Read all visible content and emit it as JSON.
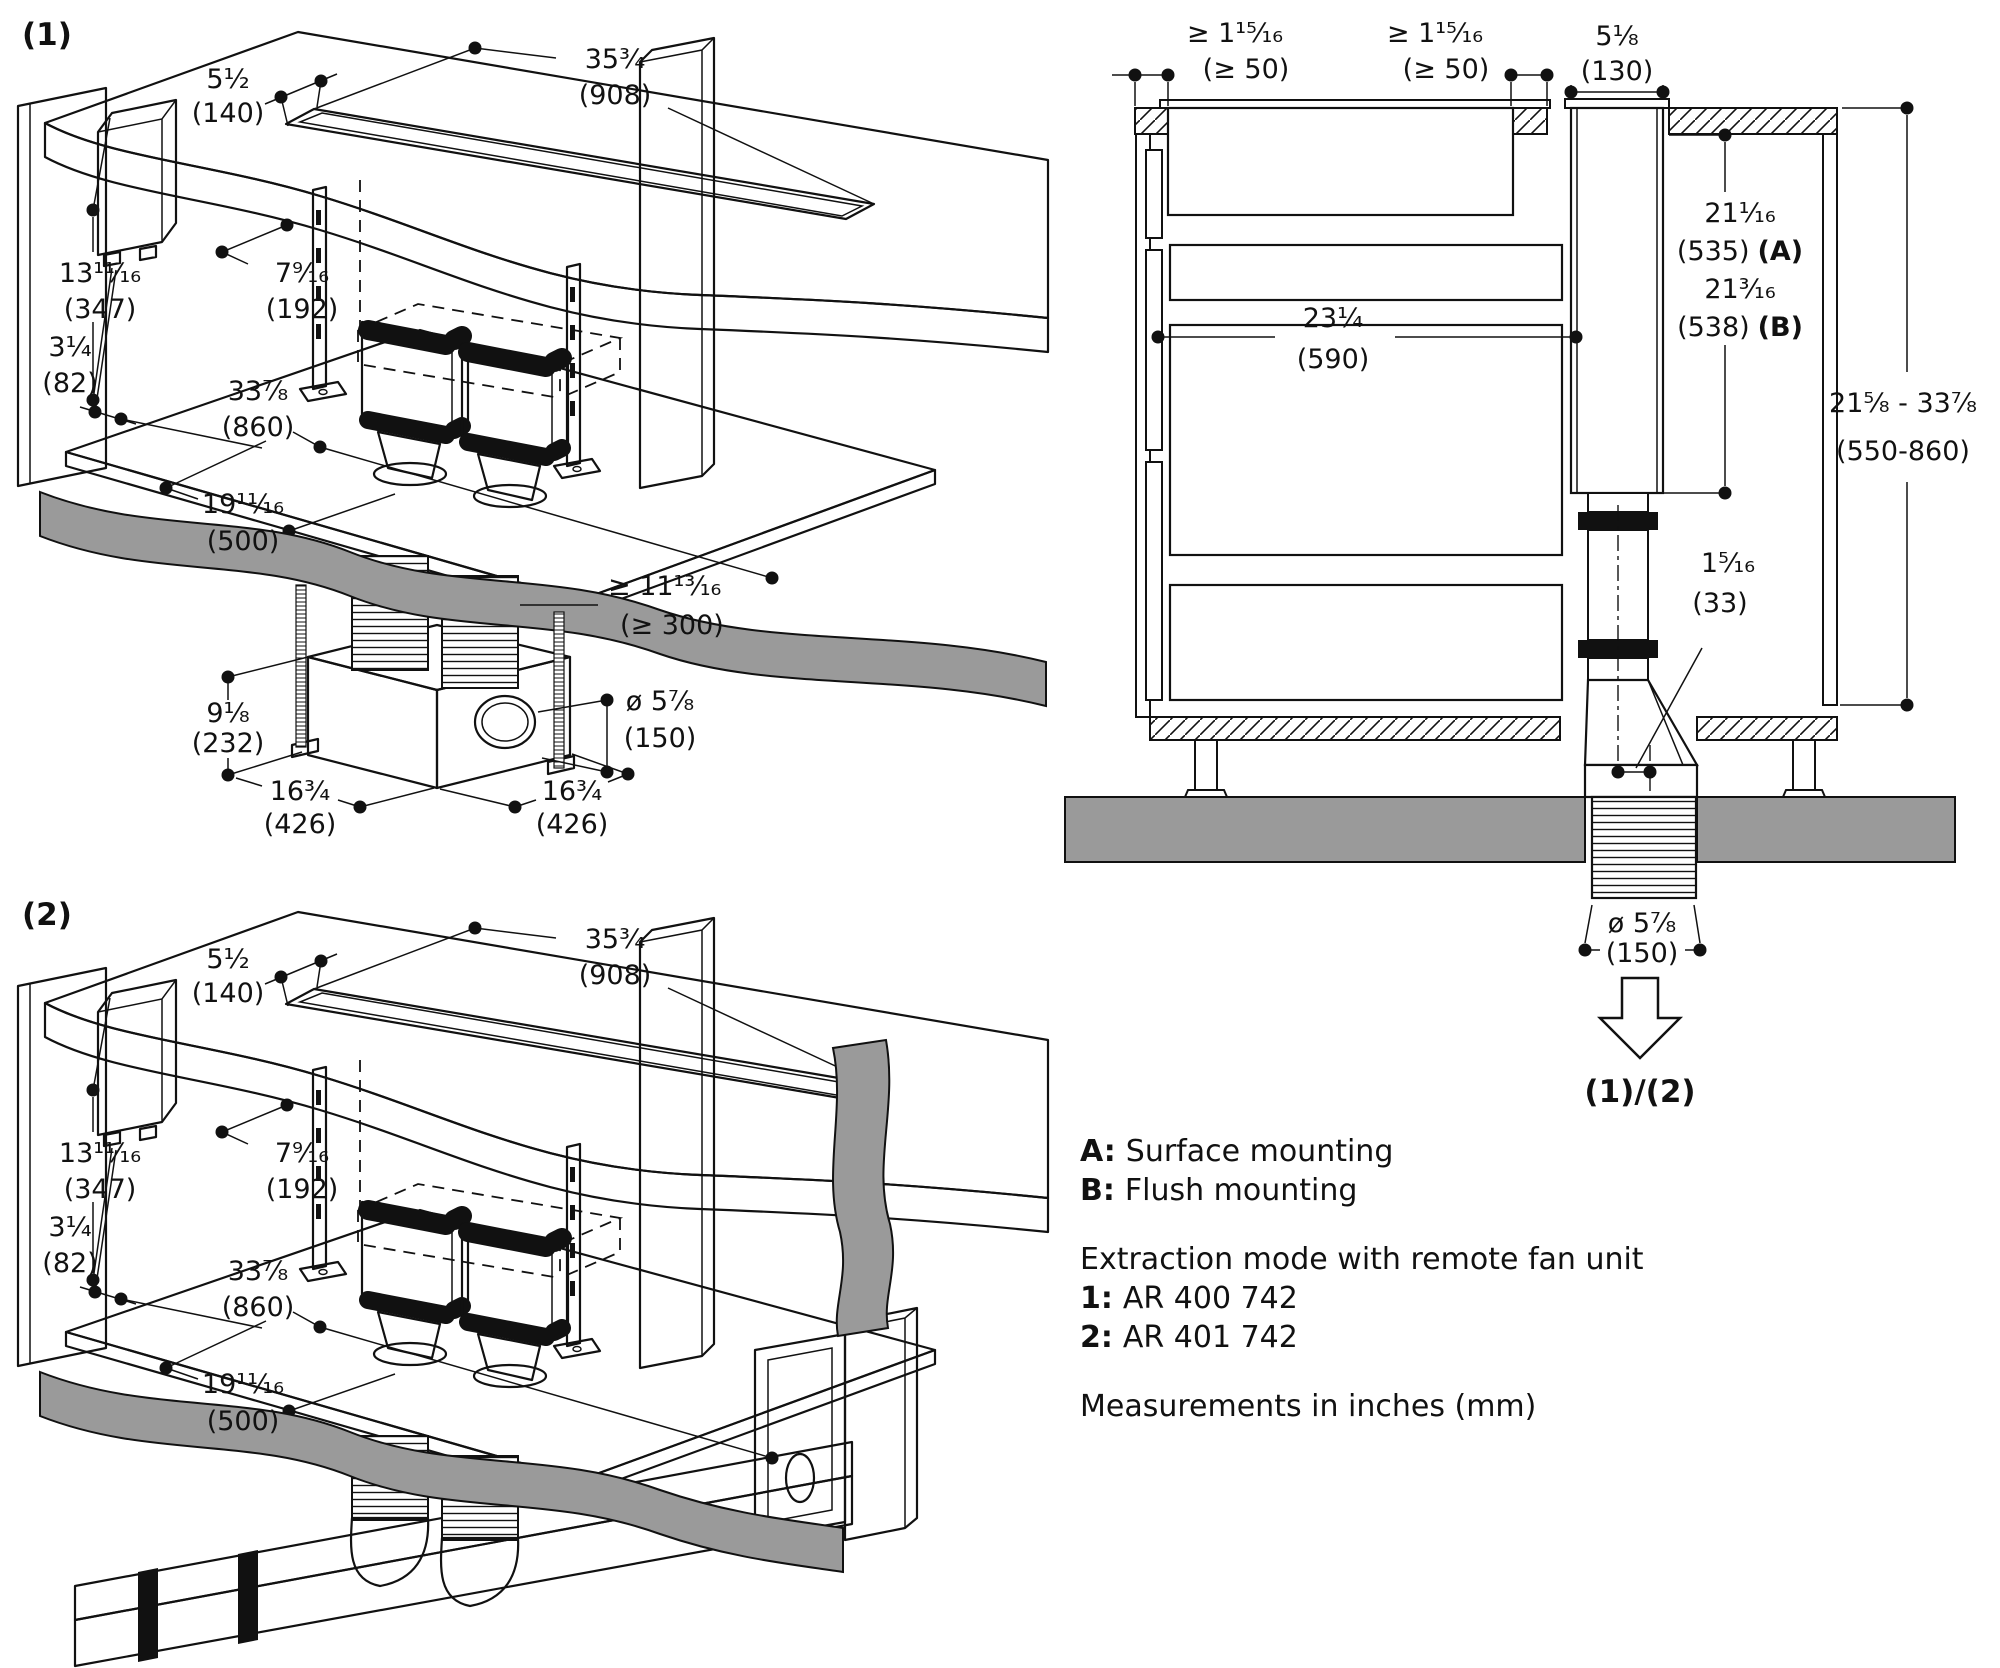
{
  "figures": {
    "fig1": "(1)",
    "fig2": "(2)",
    "applies_to": "(1)/(2)"
  },
  "colors": {
    "line": "#111111",
    "floor_gray": "#9a9a9a",
    "shelf_gray": "#e4e4e4",
    "clamp_black": "#111111"
  },
  "dims": {
    "counter_depth": {
      "in": "5¹⁄₂",
      "mm": "(140)"
    },
    "cutout_width": {
      "in": "35³⁄₄",
      "mm": "(908)"
    },
    "box_height": {
      "in": "13¹¹⁄₁₆",
      "mm": "(347)"
    },
    "box_depth": {
      "in": "7⁹⁄₁₆",
      "mm": "(192)"
    },
    "box_clearance": {
      "in": "3¹⁄₄",
      "mm": "(82)"
    },
    "shelf_width": {
      "in": "33⁷⁄₈",
      "mm": "(860)"
    },
    "shelf_depth": {
      "in": "19¹¹⁄₁₆",
      "mm": "(500)"
    },
    "duct_min_length": {
      "in": "≥ 11¹³⁄₁₆",
      "mm": "(≥ 300)"
    },
    "port_diameter": {
      "in": "ø 5⁷⁄₈",
      "mm": "(150)"
    },
    "fan_height": {
      "in": "9¹⁄₈",
      "mm": "(232)"
    },
    "fan_width": {
      "in": "16³⁄₄",
      "mm": "(426)"
    },
    "fan_depth": {
      "in": "16³⁄₄",
      "mm": "(426)"
    }
  },
  "section": {
    "clearance_left": {
      "in": "≥ 1¹⁵⁄₁₆",
      "mm": "(≥ 50)"
    },
    "clearance_right": {
      "in": "≥ 1¹⁵⁄₁₆",
      "mm": "(≥ 50)"
    },
    "channel_depth": {
      "in": "5¹⁄₈",
      "mm": "(130)"
    },
    "cabinet_interior": {
      "in": "23¹⁄₄",
      "mm": "(590)"
    },
    "height_surface": {
      "in": "21¹⁄₁₆",
      "mm": "(535)",
      "suffix": "(A)"
    },
    "height_flush": {
      "in": "21³⁄₁₆",
      "mm": "(538)",
      "suffix": "(B)"
    },
    "height_range": {
      "in": "21⁵⁄₈ - 33⁷⁄₈",
      "mm": "(550-860)"
    },
    "offset": {
      "in": "1⁵⁄₁₆",
      "mm": "(33)"
    },
    "duct_diameter": {
      "in": "ø 5⁷⁄₈",
      "mm": "(150)"
    }
  },
  "legend": {
    "lines": [
      {
        "prefix": "A:",
        "text": "Surface mounting"
      },
      {
        "prefix": "B:",
        "text": "Flush mounting"
      }
    ],
    "heading": "Extraction mode with remote fan unit",
    "models": [
      {
        "prefix": "1:",
        "text": "AR 400 742"
      },
      {
        "prefix": "2:",
        "text": "AR 401 742"
      }
    ],
    "note": "Measurements in inches (mm)"
  }
}
